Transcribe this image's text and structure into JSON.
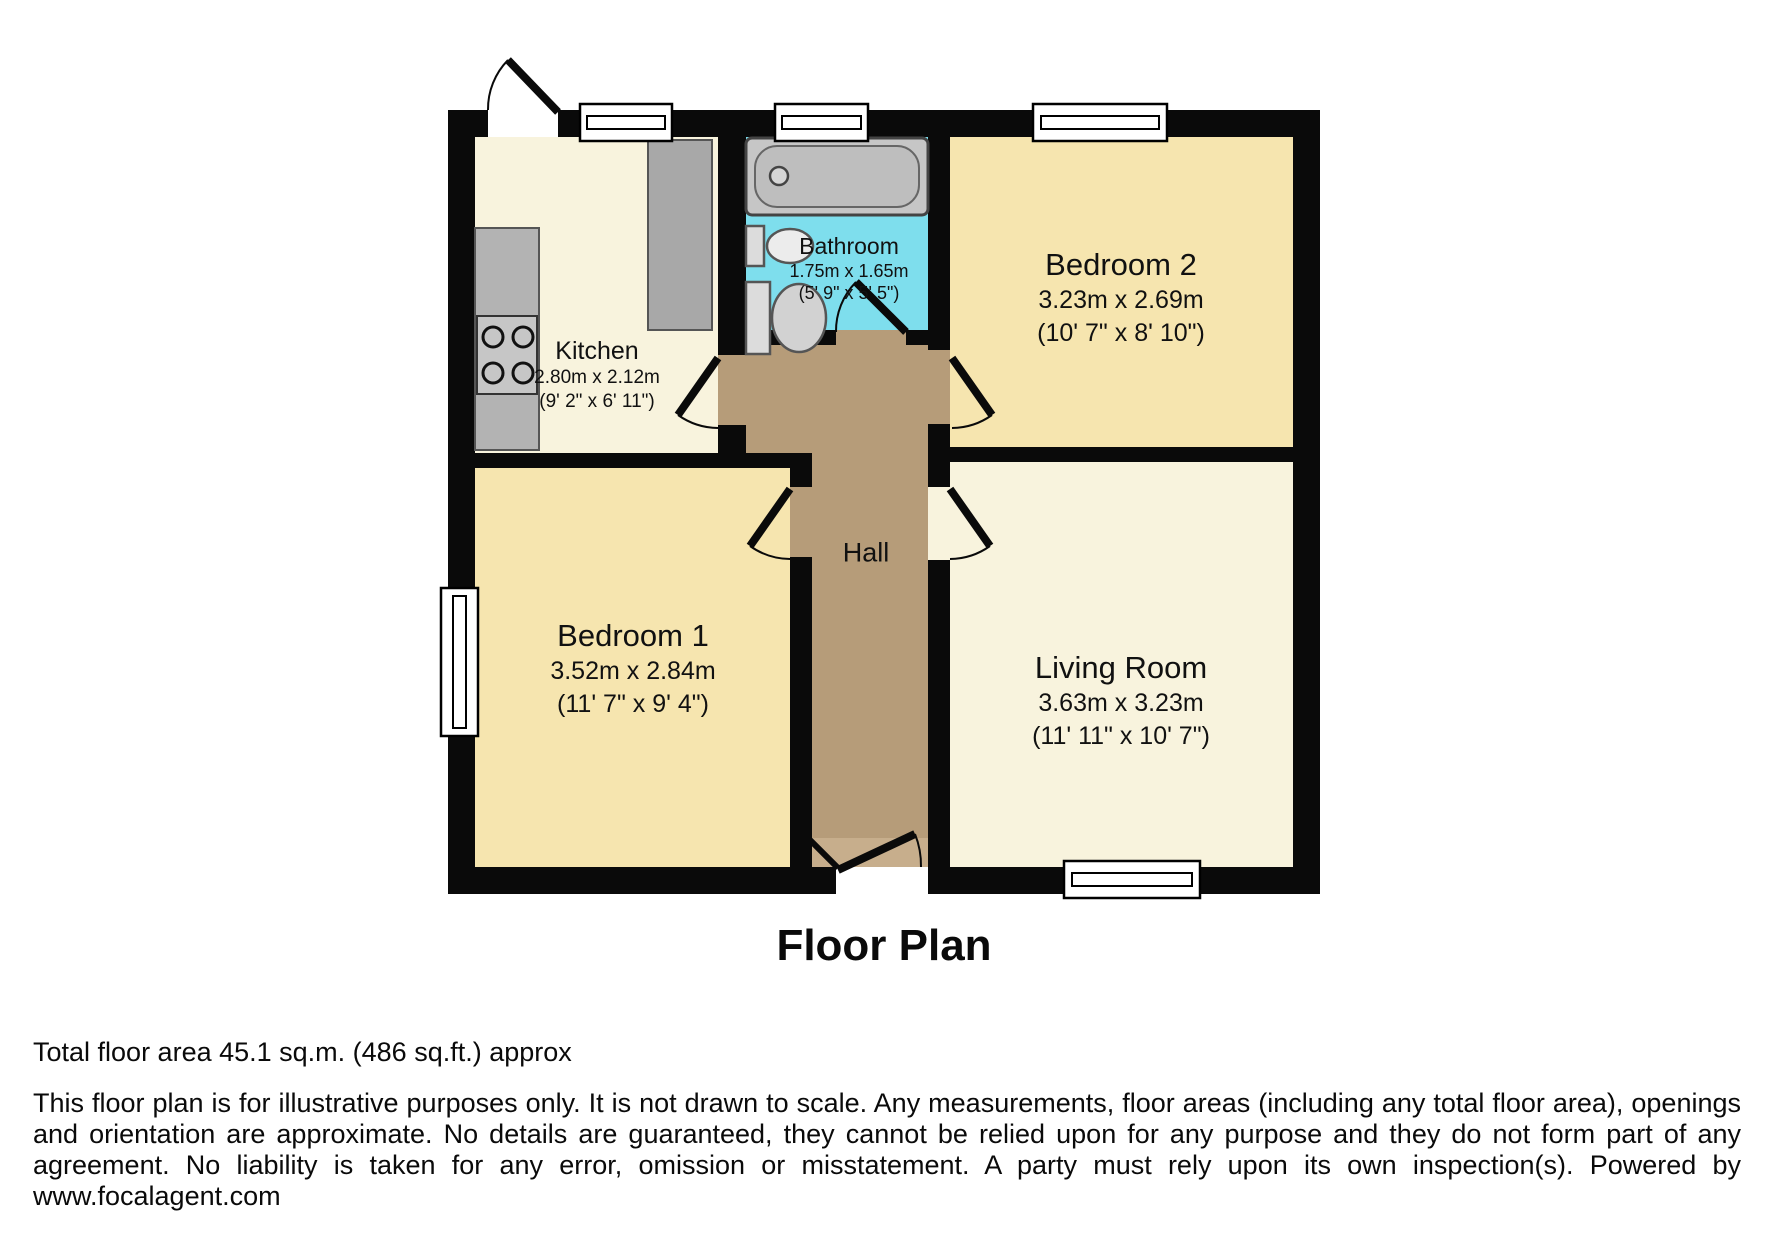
{
  "plan": {
    "title": "Floor Plan",
    "rooms": {
      "kitchen": {
        "name": "Kitchen",
        "metric": "2.80m x 2.12m",
        "imperial": "(9' 2\" x 6' 11\")"
      },
      "bathroom": {
        "name": "Bathroom",
        "metric": "1.75m x 1.65m",
        "imperial": "(5' 9\" x 5' 5\")"
      },
      "bedroom2": {
        "name": "Bedroom 2",
        "metric": "3.23m x 2.69m",
        "imperial": "(10' 7\" x 8' 10\")"
      },
      "bedroom1": {
        "name": "Bedroom 1",
        "metric": "3.52m x 2.84m",
        "imperial": "(11' 7\" x 9' 4\")"
      },
      "living_room": {
        "name": "Living Room",
        "metric": "3.63m x 3.23m",
        "imperial": "(11' 11\" x 10' 7\")"
      },
      "hall": {
        "name": "Hall"
      }
    },
    "colors": {
      "wall": "#0a0a0a",
      "cream": "#f8f3dd",
      "bedroom_yellow": "#f6e5af",
      "bathroom_cyan": "#7edeed",
      "hall_brown": "#b69c79",
      "hall_brown_light": "#c7ae8c",
      "fixture_gray": "#b3b3b3",
      "tub_gray": "#c6c6c6",
      "window_white": "#ffffff"
    }
  },
  "footer": {
    "area_line": "Total floor area 45.1 sq.m. (486 sq.ft.) approx",
    "disclaimer": "This floor plan is for illustrative purposes only. It is not drawn to scale. Any measurements, floor areas (including any total floor area), openings and orientation are approximate. No details are guaranteed, they cannot be relied upon for any purpose and they do not form part of any agreement. No liability is taken for any error, omission or misstatement. A party must rely upon its own inspection(s). Powered by www.focalagent.com"
  }
}
